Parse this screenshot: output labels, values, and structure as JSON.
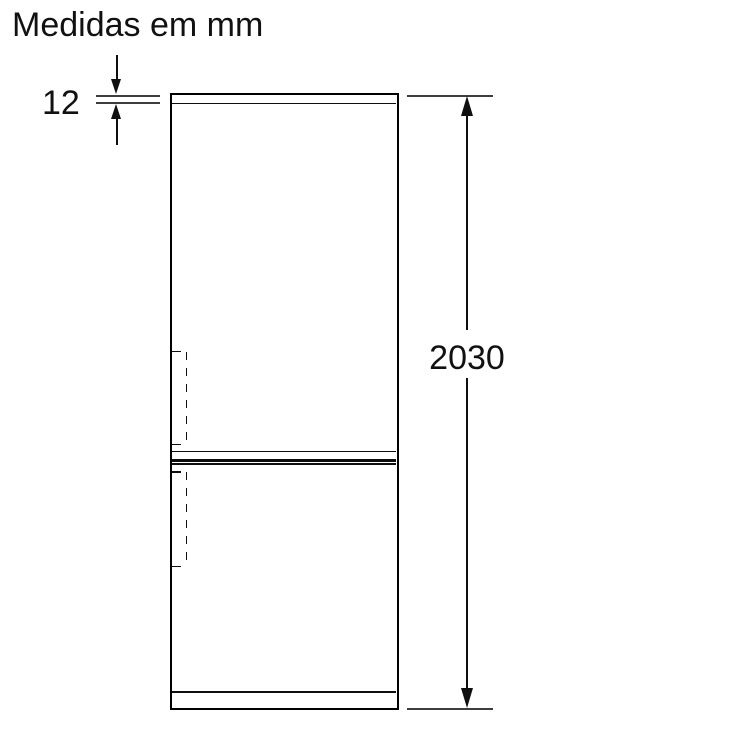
{
  "title": "Medidas em mm",
  "units": "mm",
  "diagram": {
    "kind": "refrigerator front-view dimension drawing",
    "background_color": "#ffffff",
    "outline_color": "#000000",
    "dimension_line_color": "#3d3d3d",
    "text_color": "#111111"
  },
  "dimensions": {
    "top_panel": {
      "value": "12",
      "label": "top panel thickness"
    },
    "overall_height": {
      "value": "2030",
      "label": "overall height"
    }
  }
}
